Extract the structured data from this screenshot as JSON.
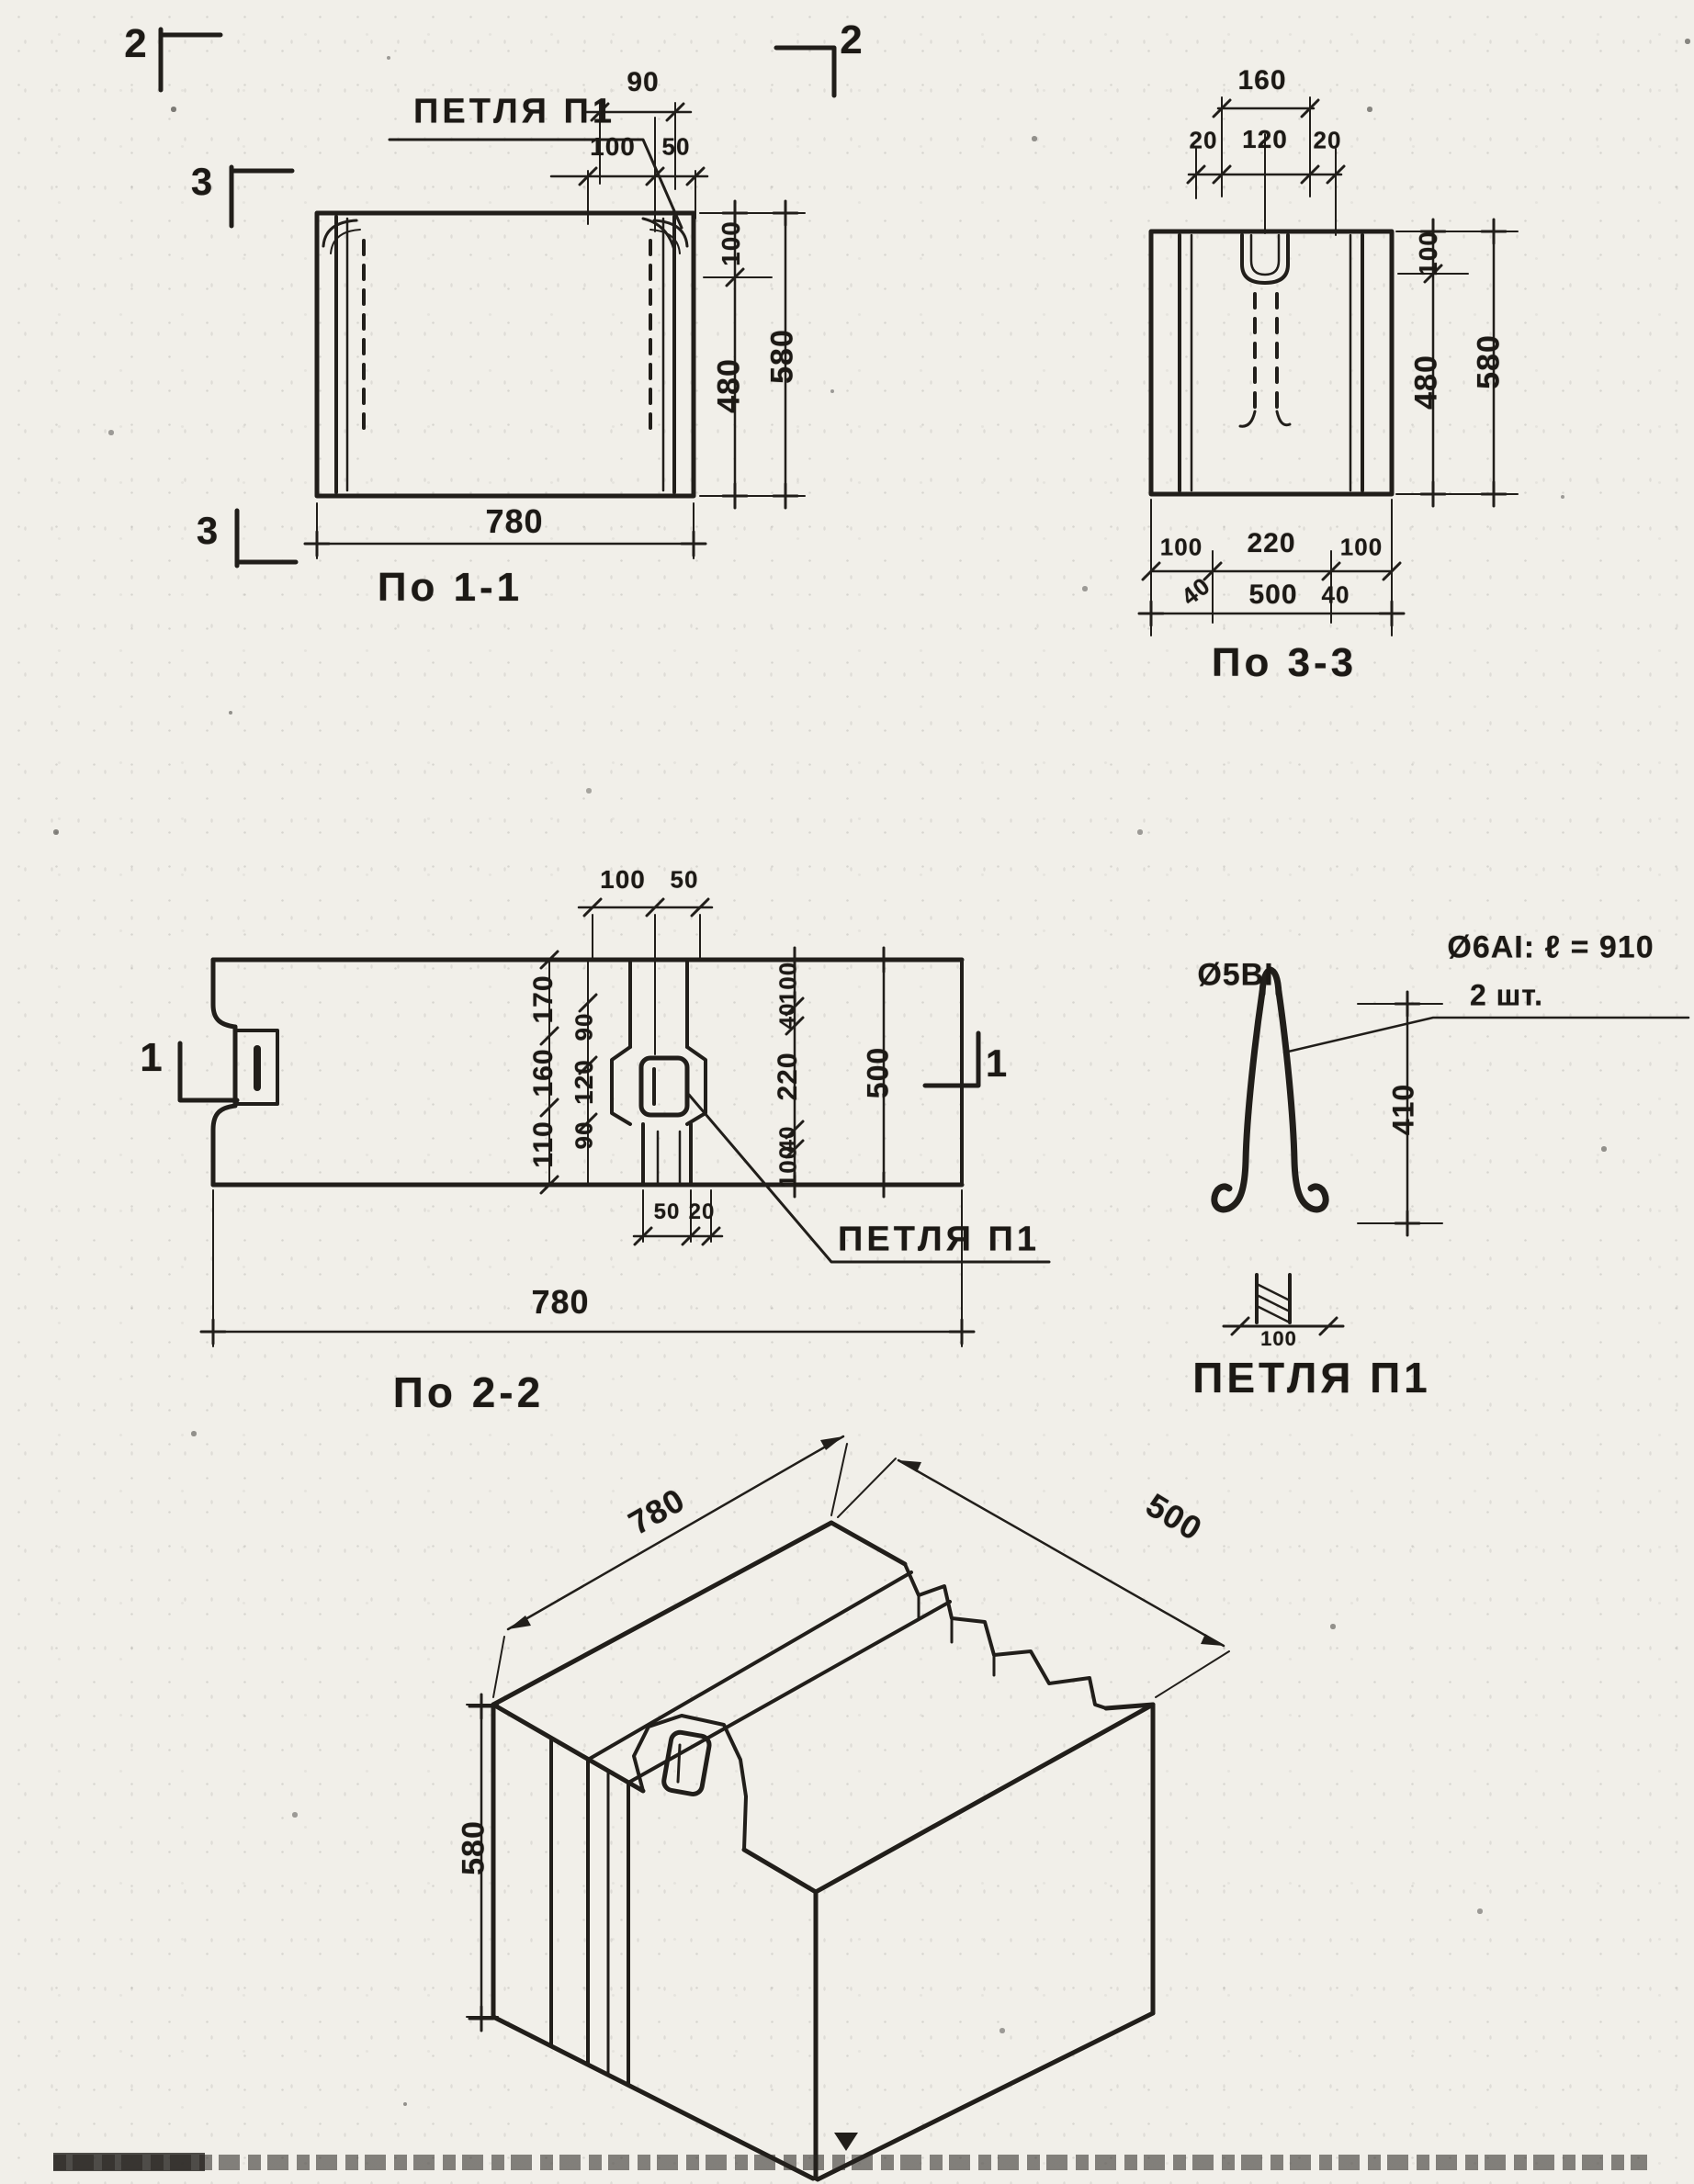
{
  "section_1_1": {
    "caption": "По 1-1",
    "loop_label": "ПЕТЛЯ П1",
    "marker_top_left": "2",
    "marker_top_right": "2",
    "marker_mid_left": "3",
    "marker_bottom_left": "3",
    "dim_top_offset": "90",
    "dim_top_chain": [
      "100",
      "50"
    ],
    "dim_right_chain": [
      "100",
      "480"
    ],
    "dim_right_total": "580",
    "dim_bottom": "780"
  },
  "section_3_3": {
    "caption": "По 3-3",
    "dim_top_total": "160",
    "dim_top_chain": [
      "20",
      "120",
      "20"
    ],
    "dim_right_chain": [
      "100",
      "480"
    ],
    "dim_right_total": "580",
    "dim_bottom_chain": [
      "100",
      "220",
      "100"
    ],
    "dim_bottom_ends": [
      "40",
      "40"
    ],
    "dim_bottom_total": "500"
  },
  "section_2_2": {
    "caption": "По 2-2",
    "loop_label": "ПЕТЛЯ П1",
    "marker_left": "1",
    "marker_right": "1",
    "dim_top_chain": [
      "100",
      "50"
    ],
    "dim_mid_col_a": [
      "170",
      "160",
      "110"
    ],
    "dim_mid_col_b": [
      "90",
      "120",
      "90"
    ],
    "dim_right_chain": [
      "100",
      "40",
      "220",
      "40",
      "100"
    ],
    "dim_right_total": "500",
    "dim_slot_chain": [
      "50",
      "20"
    ],
    "dim_bottom": "780"
  },
  "loop_detail": {
    "caption": "ПЕТЛЯ П1",
    "bar_label": "Ø5ВI",
    "note_line_1": "Ø6АI: ℓ = 910",
    "note_line_2": "2 шт.",
    "dim_height": "410",
    "dim_width": "100"
  },
  "isometric": {
    "dim_length": "780",
    "dim_depth": "500",
    "dim_height": "580"
  }
}
